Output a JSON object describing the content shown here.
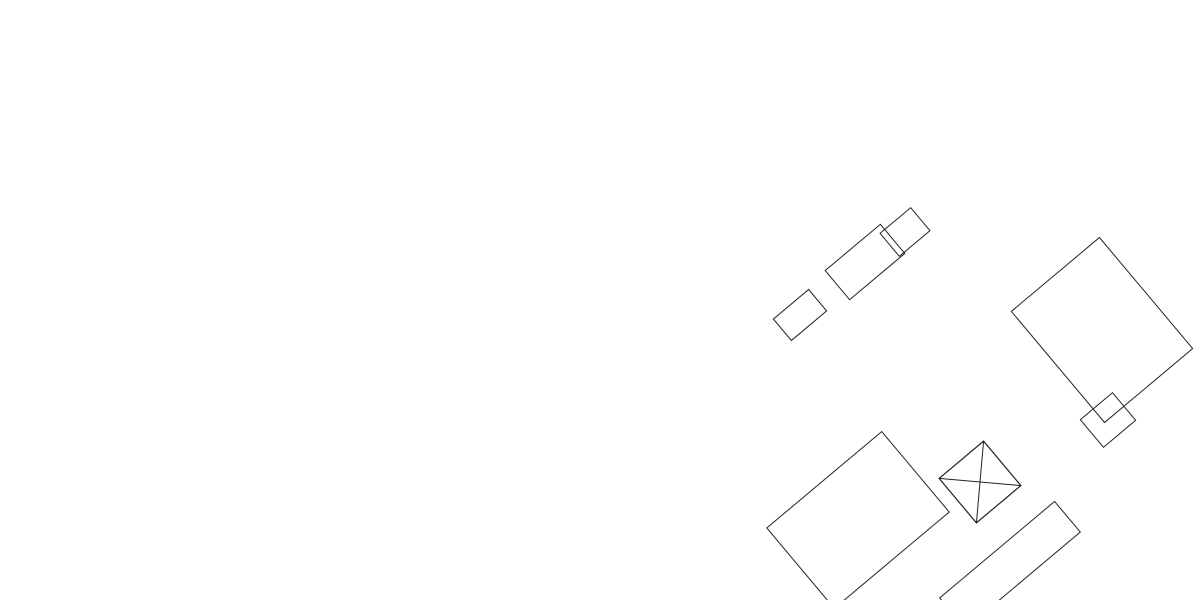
{
  "map": {
    "title": "development-site-plan",
    "streets": [
      {
        "id": "am-delpens",
        "name": "Am Delpens"
      },
      {
        "id": "hollmardreisch",
        "name": "Hollmardreisch"
      },
      {
        "id": "am-voelkerbach-upper",
        "name": "Am Völkerbach"
      },
      {
        "id": "am-voelkerbach-lower",
        "name": "Am Völkerbach"
      },
      {
        "id": "cherusker-strasse",
        "name": "Cherusker Straße"
      }
    ],
    "zone_colors": {
      "blue": "#cfe3e6",
      "gold": "#efb63c",
      "orange": "#ef9f2b",
      "yellow": "#f8ec43",
      "cream": "#f3ebc4",
      "green": "#3d8a4d",
      "street_gray": "#a8a3a8",
      "boundary_red": "#c2272d",
      "stream_blue": "#1f5d94",
      "marker_blue": "#2a4da8"
    },
    "parcels": [
      {
        "id": "564",
        "zone": "blue"
      },
      {
        "id": "565",
        "zone": "blue"
      },
      {
        "id": "566",
        "zone": "blue"
      },
      {
        "id": "567",
        "zone": "blue"
      },
      {
        "id": "568",
        "zone": "blue"
      },
      {
        "id": "569",
        "zone": "blue"
      },
      {
        "id": "570",
        "zone": "blue"
      },
      {
        "id": "571",
        "zone": "blue"
      },
      {
        "id": "572",
        "zone": "blue"
      },
      {
        "id": "573",
        "zone": "blue"
      },
      {
        "id": "574",
        "zone": "blue"
      },
      {
        "id": "575",
        "zone": "cream"
      },
      {
        "id": "576",
        "zone": "blue"
      },
      {
        "id": "577",
        "zone": "blue"
      },
      {
        "id": "578",
        "zone": "gold"
      },
      {
        "id": "579",
        "zone": "blue"
      },
      {
        "id": "580",
        "zone": "blue"
      },
      {
        "id": "586",
        "zone": "yellow"
      },
      {
        "id": "588",
        "zone": "yellow"
      },
      {
        "id": "589",
        "zone": "yellow"
      },
      {
        "id": "590",
        "zone": "yellow"
      },
      {
        "id": "591",
        "zone": "yellow"
      },
      {
        "id": "592",
        "zone": "blue"
      },
      {
        "id": "593",
        "zone": "blue"
      },
      {
        "id": "594",
        "zone": "gold"
      },
      {
        "id": "595",
        "zone": "gold"
      },
      {
        "id": "596",
        "zone": "orange"
      },
      {
        "id": "597",
        "zone": "blue"
      },
      {
        "id": "598",
        "zone": "blue"
      },
      {
        "id": "599",
        "zone": "orange"
      },
      {
        "id": "600",
        "zone": "blue"
      },
      {
        "id": "601",
        "zone": "orange"
      },
      {
        "id": "602",
        "zone": "orange"
      },
      {
        "id": "603",
        "zone": "orange"
      },
      {
        "id": "604",
        "zone": "orange"
      },
      {
        "id": "605",
        "zone": "orange"
      },
      {
        "id": "606",
        "zone": "gold"
      },
      {
        "id": "607",
        "zone": "blue"
      },
      {
        "id": "608",
        "zone": "blue"
      },
      {
        "id": "609",
        "zone": "blue"
      },
      {
        "id": "610",
        "zone": "blue"
      },
      {
        "id": "611",
        "zone": "blue"
      },
      {
        "id": "612",
        "zone": "blue"
      },
      {
        "id": "613",
        "zone": "blue"
      },
      {
        "id": "614",
        "zone": "blue"
      },
      {
        "id": "615",
        "zone": "blue"
      },
      {
        "id": "616",
        "zone": "blue"
      },
      {
        "id": "617",
        "zone": "blue"
      },
      {
        "id": "618",
        "zone": "blue"
      },
      {
        "id": "619",
        "zone": "blue"
      },
      {
        "id": "620",
        "zone": "blue"
      },
      {
        "id": "621",
        "zone": "blue"
      },
      {
        "id": "622",
        "zone": "blue"
      },
      {
        "id": "623",
        "zone": "blue"
      },
      {
        "id": "624",
        "zone": "blue"
      },
      {
        "id": "625",
        "zone": "blue"
      },
      {
        "id": "626",
        "zone": "blue"
      },
      {
        "id": "627",
        "zone": "orange"
      },
      {
        "id": "628",
        "zone": "orange"
      },
      {
        "id": "629",
        "zone": "blue"
      },
      {
        "id": "630",
        "zone": "blue"
      },
      {
        "id": "631",
        "zone": "blue"
      },
      {
        "id": "632",
        "zone": "blue"
      },
      {
        "id": "633",
        "zone": "blue"
      }
    ],
    "street_parcel_labels": [
      "639",
      "640",
      "641",
      "642"
    ],
    "existing_parcel_labels": [
      "27",
      "26",
      "201",
      "202",
      "525",
      "529",
      "461",
      "524",
      "521",
      "148",
      "325",
      "327",
      "409",
      "643"
    ],
    "green_area_labels": [
      "658",
      "656",
      "649",
      "651"
    ],
    "boundary_label": "54",
    "icons": [
      {
        "name": "waste-container-icon",
        "at_green_area": "658"
      },
      {
        "name": "north-arrow"
      }
    ]
  }
}
